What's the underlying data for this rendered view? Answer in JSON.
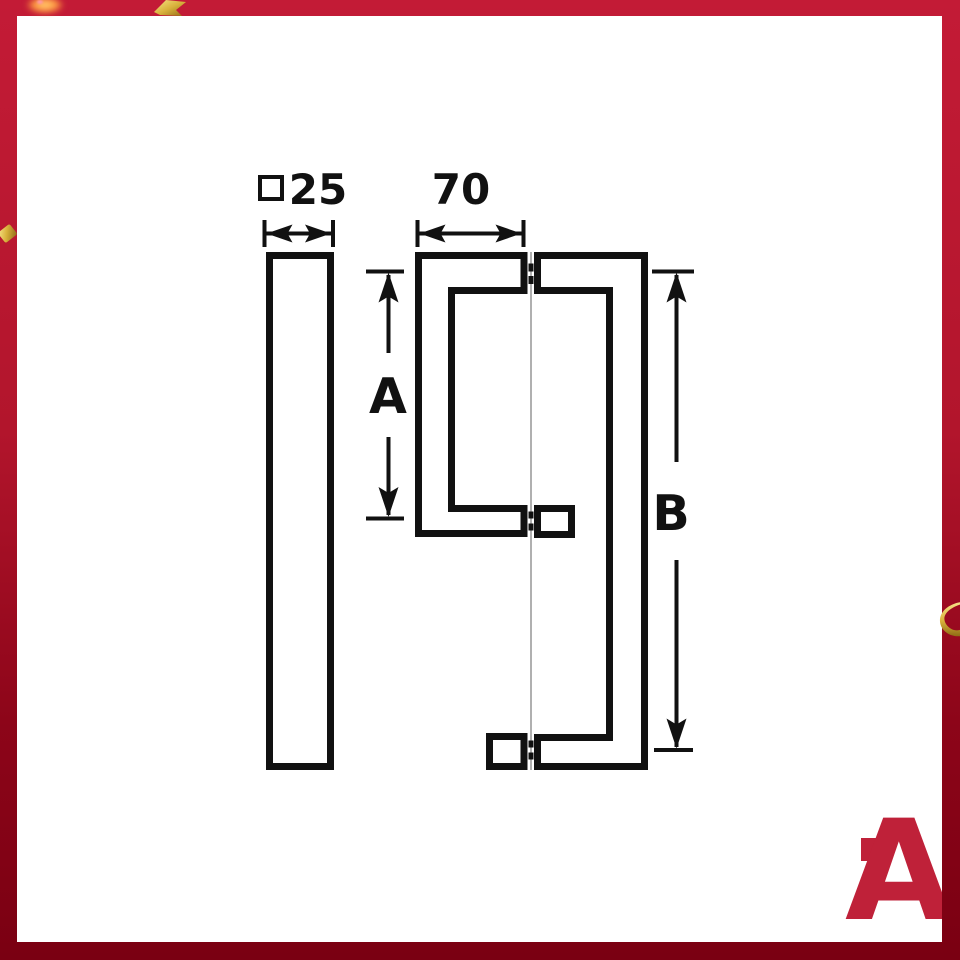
{
  "frame": {
    "border_gradient_top": "#c31b36",
    "border_gradient_bottom": "#7a0012",
    "confetti_gold": "#d9b23c",
    "confetti_orange": "#ff9a40"
  },
  "drawing": {
    "stroke_color": "#111111",
    "glass_line_color": "#b0b0b0",
    "labels": {
      "cross_section_value": "25",
      "cross_section_symbol": "square-section-icon",
      "top_width": "70",
      "height_a": "A",
      "height_b": "B"
    }
  },
  "logo": {
    "letter": "A",
    "color": "#bf2139"
  }
}
